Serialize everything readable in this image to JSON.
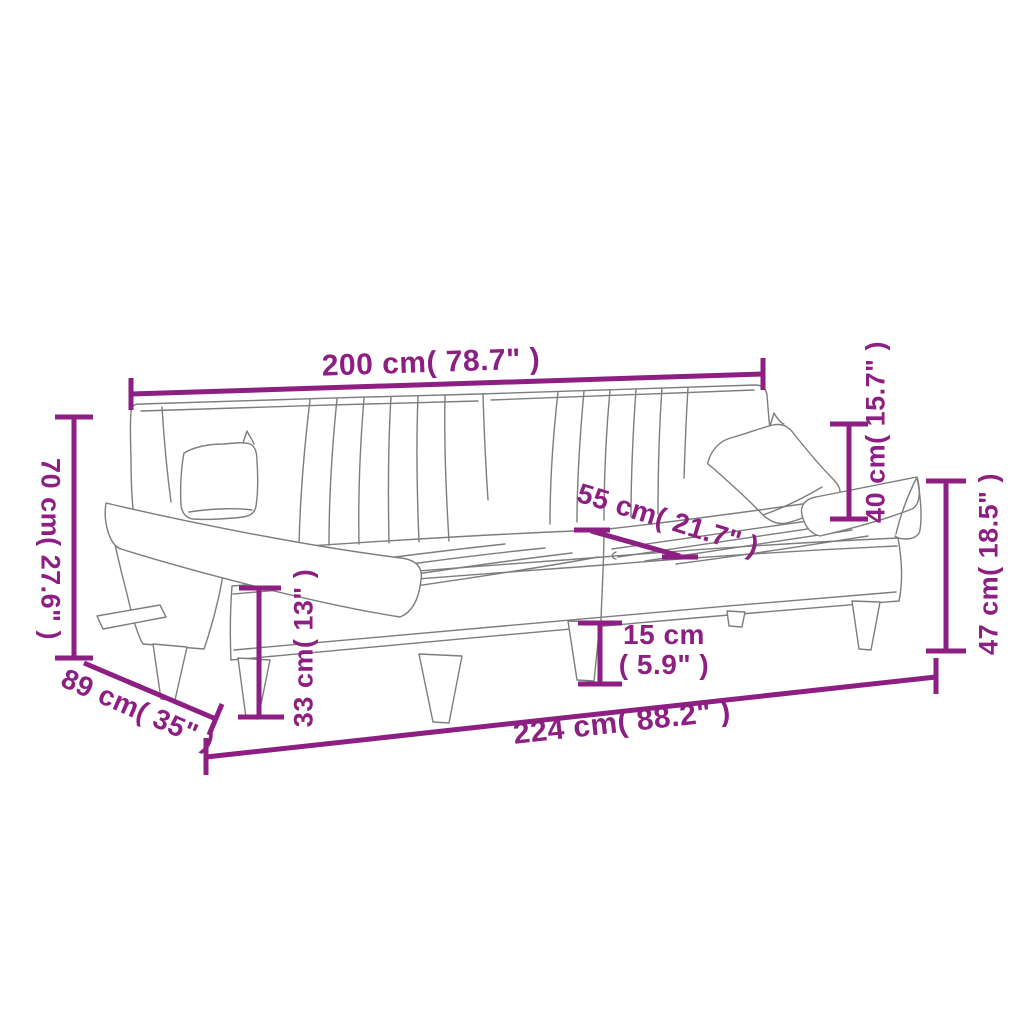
{
  "diagram": {
    "title": "sofa-bed-dimension-diagram",
    "colors": {
      "dimension_accent": "#8D1E82",
      "sketch_line": "#7d7d7d",
      "background": "#ffffff"
    },
    "dimensions": {
      "back_width": "200 cm( 78.7\" )",
      "back_height": "70 cm( 27.6\" )",
      "depth": "89 cm( 35\" )",
      "seat_depth": "55 cm( 21.7\" )",
      "backrest_above_seat": "40 cm( 15.7\" )",
      "armrest_height": "47 cm( 18.5\" )",
      "seat_height": "33 cm( 13\" )",
      "leg_height_cm": "15 cm",
      "leg_height_inch": "( 5.9\" )",
      "total_width": "224 cm( 88.2\" )"
    }
  }
}
